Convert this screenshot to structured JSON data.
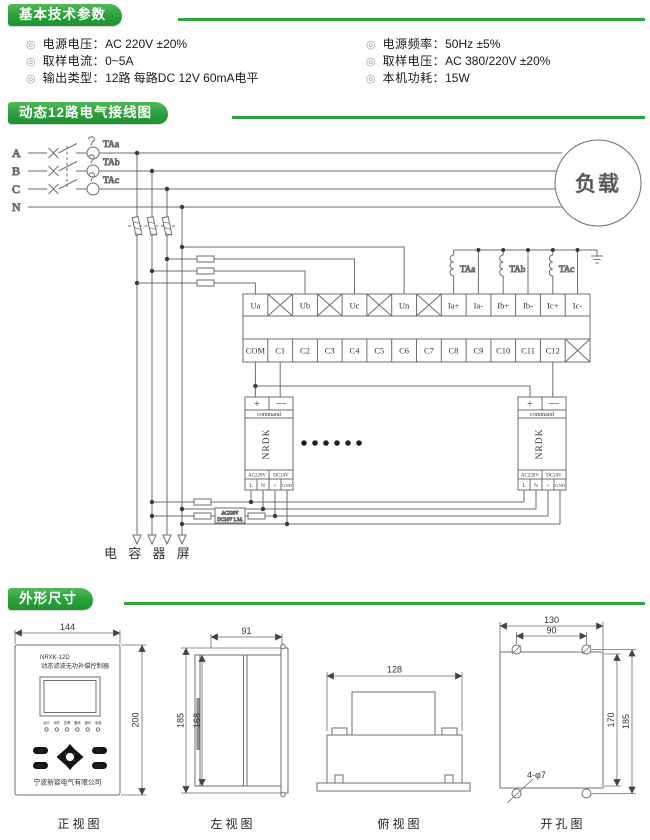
{
  "theme": {
    "banner_green": "#2aa03c",
    "line_gray": "#6e6e6e",
    "text_dark": "#1a1a1a"
  },
  "params": {
    "title": "基本技术参数",
    "bullet": "◎",
    "left": [
      {
        "label": "电源电压：",
        "value": "AC 220V ±20%"
      },
      {
        "label": "取样电流：",
        "value": "0~5A"
      },
      {
        "label": "输出类型：",
        "value": "12路 每路DC 12V 60mA电平"
      }
    ],
    "right": [
      {
        "label": "电源频率：",
        "value": "50Hz ±5%"
      },
      {
        "label": "取样电压：",
        "value": "AC 380/220V ±20%"
      },
      {
        "label": "本机功耗：",
        "value": "15W"
      }
    ]
  },
  "wiring": {
    "title": "动态12路电气接线图",
    "phases": [
      "A",
      "B",
      "C",
      "N"
    ],
    "ct_primary": [
      "TAa",
      "TAb",
      "TAc"
    ],
    "ct_secondary": [
      "TAa",
      "TAb",
      "TAc"
    ],
    "load": "负载",
    "row1": [
      "Ua",
      "Ub",
      "Uc",
      "Un",
      "Ia+",
      "Ia-",
      "Ib+",
      "Ib-",
      "Ic+",
      "Ic-"
    ],
    "row2": [
      "COM",
      "C1",
      "C2",
      "C3",
      "C4",
      "C5",
      "C6",
      "C7",
      "C8",
      "C9",
      "C10",
      "C11",
      "C12"
    ],
    "module": {
      "plus": "+",
      "minus": "—",
      "command": "command",
      "name": "NRDK",
      "supply_ac": "AC220V",
      "supply_dc": "DC24V",
      "terms": [
        "L",
        "N",
        "+",
        "GND"
      ]
    },
    "adapter": {
      "line1": "AC220V",
      "line2": "DC24V 1.3A"
    },
    "capacitor_bank": "电 容 器 屏"
  },
  "dims": {
    "title": "外形尺寸",
    "front": {
      "caption": "正视图",
      "model": "NRXK-12D",
      "name": "动态滤波无功补偿控制器",
      "company": "宁波新容电气有限公司",
      "w": "144",
      "h": "200",
      "leds": [
        "运行",
        "动作",
        "告警",
        "备用",
        "通讯",
        "电源"
      ],
      "btn_set": "设置",
      "btn_ok": "确认",
      "btn_reset": "复位",
      "btn_esc": "退出"
    },
    "left": {
      "caption": "左视图",
      "w": "91",
      "h_outer": "185",
      "h_inner": "168"
    },
    "top": {
      "caption": "俯视图",
      "w": "128"
    },
    "holes": {
      "caption": "开孔图",
      "w_outer": "130",
      "w_inner": "90",
      "h_inner": "170",
      "h_outer": "185",
      "note": "4-φ7"
    }
  }
}
